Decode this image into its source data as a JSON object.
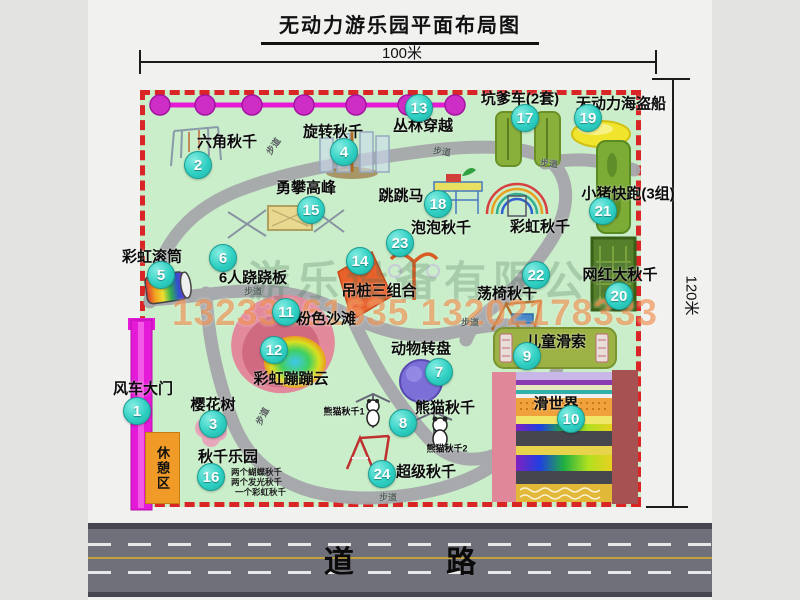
{
  "title": "无动力游乐园平面布局图",
  "dimensions": {
    "width_label": "100米",
    "height_label": "120米"
  },
  "watermark": {
    "company": "游乐设备有限公司",
    "phones": "13233861635 13202178333"
  },
  "road": {
    "label": "道 路"
  },
  "path_label_text": "步道",
  "colors": {
    "park_green": "#c9eec9",
    "border_red": "#d92525",
    "badge_teal": "#2fd0c3",
    "gate_magenta": "#e41ad8",
    "rest_orange": "#f09a28",
    "road_gray": "#70707a",
    "phone_watermark": "#e97628"
  },
  "map": {
    "items": [
      {
        "num": "1",
        "label": "风车大门",
        "badge": {
          "x": 137,
          "y": 411
        },
        "pos": {
          "x": 143,
          "y": 388
        }
      },
      {
        "num": "2",
        "label": "六角秋千",
        "badge": {
          "x": 198,
          "y": 165
        },
        "pos": {
          "x": 227,
          "y": 141
        }
      },
      {
        "num": "3",
        "label": "樱花树",
        "badge": {
          "x": 213,
          "y": 424
        },
        "pos": {
          "x": 213,
          "y": 404
        }
      },
      {
        "num": "4",
        "label": "旋转秋千",
        "badge": {
          "x": 344,
          "y": 152
        },
        "pos": {
          "x": 333,
          "y": 131
        }
      },
      {
        "num": "5",
        "label": "彩虹滚筒",
        "badge": {
          "x": 161,
          "y": 275
        },
        "pos": {
          "x": 152,
          "y": 256
        }
      },
      {
        "num": "6",
        "label": "6人跷跷板",
        "badge": {
          "x": 223,
          "y": 258
        },
        "pos": {
          "x": 253,
          "y": 277
        }
      },
      {
        "num": "7",
        "label": "动物转盘",
        "badge": {
          "x": 439,
          "y": 372
        },
        "pos": {
          "x": 421,
          "y": 348
        }
      },
      {
        "num": "8",
        "label": "熊猫秋千",
        "badge": {
          "x": 403,
          "y": 423
        },
        "pos": {
          "x": 445,
          "y": 407
        }
      },
      {
        "num": "9",
        "label": "儿童滑索",
        "badge": {
          "x": 527,
          "y": 356
        },
        "pos": {
          "x": 556,
          "y": 341
        }
      },
      {
        "num": "10",
        "label": "滑世界",
        "badge": {
          "x": 571,
          "y": 419
        },
        "pos": {
          "x": 556,
          "y": 403
        }
      },
      {
        "num": "11",
        "label": "粉色沙滩",
        "badge": {
          "x": 286,
          "y": 312
        },
        "pos": {
          "x": 326,
          "y": 318
        }
      },
      {
        "num": "12",
        "label": "彩虹蹦蹦云",
        "badge": {
          "x": 274,
          "y": 350
        },
        "pos": {
          "x": 291,
          "y": 378
        }
      },
      {
        "num": "13",
        "label": "丛林穿越",
        "badge": {
          "x": 419,
          "y": 108
        },
        "pos": {
          "x": 423,
          "y": 125
        }
      },
      {
        "num": "14",
        "label": "吊桩三组合",
        "badge": {
          "x": 360,
          "y": 261
        },
        "pos": {
          "x": 379,
          "y": 290
        }
      },
      {
        "num": "15",
        "label": "勇攀高峰",
        "badge": {
          "x": 311,
          "y": 210
        },
        "pos": {
          "x": 306,
          "y": 187
        }
      },
      {
        "num": "16",
        "label": "秋千乐园",
        "badge": {
          "x": 211,
          "y": 477
        },
        "pos": {
          "x": 228,
          "y": 456
        }
      },
      {
        "num": "17",
        "label": "坑爹车(2套)",
        "badge": {
          "x": 525,
          "y": 118
        },
        "pos": {
          "x": 520,
          "y": 98
        }
      },
      {
        "num": "18",
        "label": "跳跳马",
        "badge": {
          "x": 438,
          "y": 204
        },
        "pos": {
          "x": 401,
          "y": 195
        }
      },
      {
        "num": "19",
        "label": "无动力海盗船",
        "badge": {
          "x": 588,
          "y": 118
        },
        "pos": {
          "x": 621,
          "y": 103
        }
      },
      {
        "num": "20",
        "label": "网红大秋千",
        "badge": {
          "x": 619,
          "y": 296
        },
        "pos": {
          "x": 620,
          "y": 274
        }
      },
      {
        "num": "21",
        "label": "小猪快跑(3组)",
        "badge": {
          "x": 603,
          "y": 211
        },
        "pos": {
          "x": 628,
          "y": 193
        }
      },
      {
        "num": "22",
        "label": "荡椅秋千",
        "badge": {
          "x": 536,
          "y": 275
        },
        "pos": {
          "x": 507,
          "y": 293
        }
      },
      {
        "num": "23",
        "label": "泡泡秋千",
        "badge": {
          "x": 400,
          "y": 243
        },
        "pos": {
          "x": 441,
          "y": 227
        }
      },
      {
        "num": "24",
        "label": "超级秋千",
        "badge": {
          "x": 382,
          "y": 474
        },
        "pos": {
          "x": 426,
          "y": 471
        }
      }
    ],
    "extra_labels": [
      {
        "text": "彩虹秋千",
        "x": 540,
        "y": 226,
        "small": false
      },
      {
        "text": "熊猫秋千1",
        "x": 344,
        "y": 411,
        "small": true
      },
      {
        "text": "熊猫秋千2",
        "x": 447,
        "y": 448,
        "small": true
      }
    ],
    "rest_area_label": "休憩区",
    "swing_park_notes": [
      {
        "text": "两个蝴蝶秋千",
        "x": 231,
        "y": 472
      },
      {
        "text": "两个发光秋千",
        "x": 231,
        "y": 482
      },
      {
        "text": "一个彩虹秋千",
        "x": 235,
        "y": 492
      }
    ],
    "path_labels": [
      {
        "x": 273,
        "y": 146,
        "rot": -55
      },
      {
        "x": 442,
        "y": 151,
        "rot": 8
      },
      {
        "x": 549,
        "y": 163,
        "rot": 6
      },
      {
        "x": 253,
        "y": 291,
        "rot": 0
      },
      {
        "x": 262,
        "y": 416,
        "rot": -62
      },
      {
        "x": 388,
        "y": 497,
        "rot": 0
      },
      {
        "x": 470,
        "y": 322,
        "rot": 0
      }
    ]
  }
}
